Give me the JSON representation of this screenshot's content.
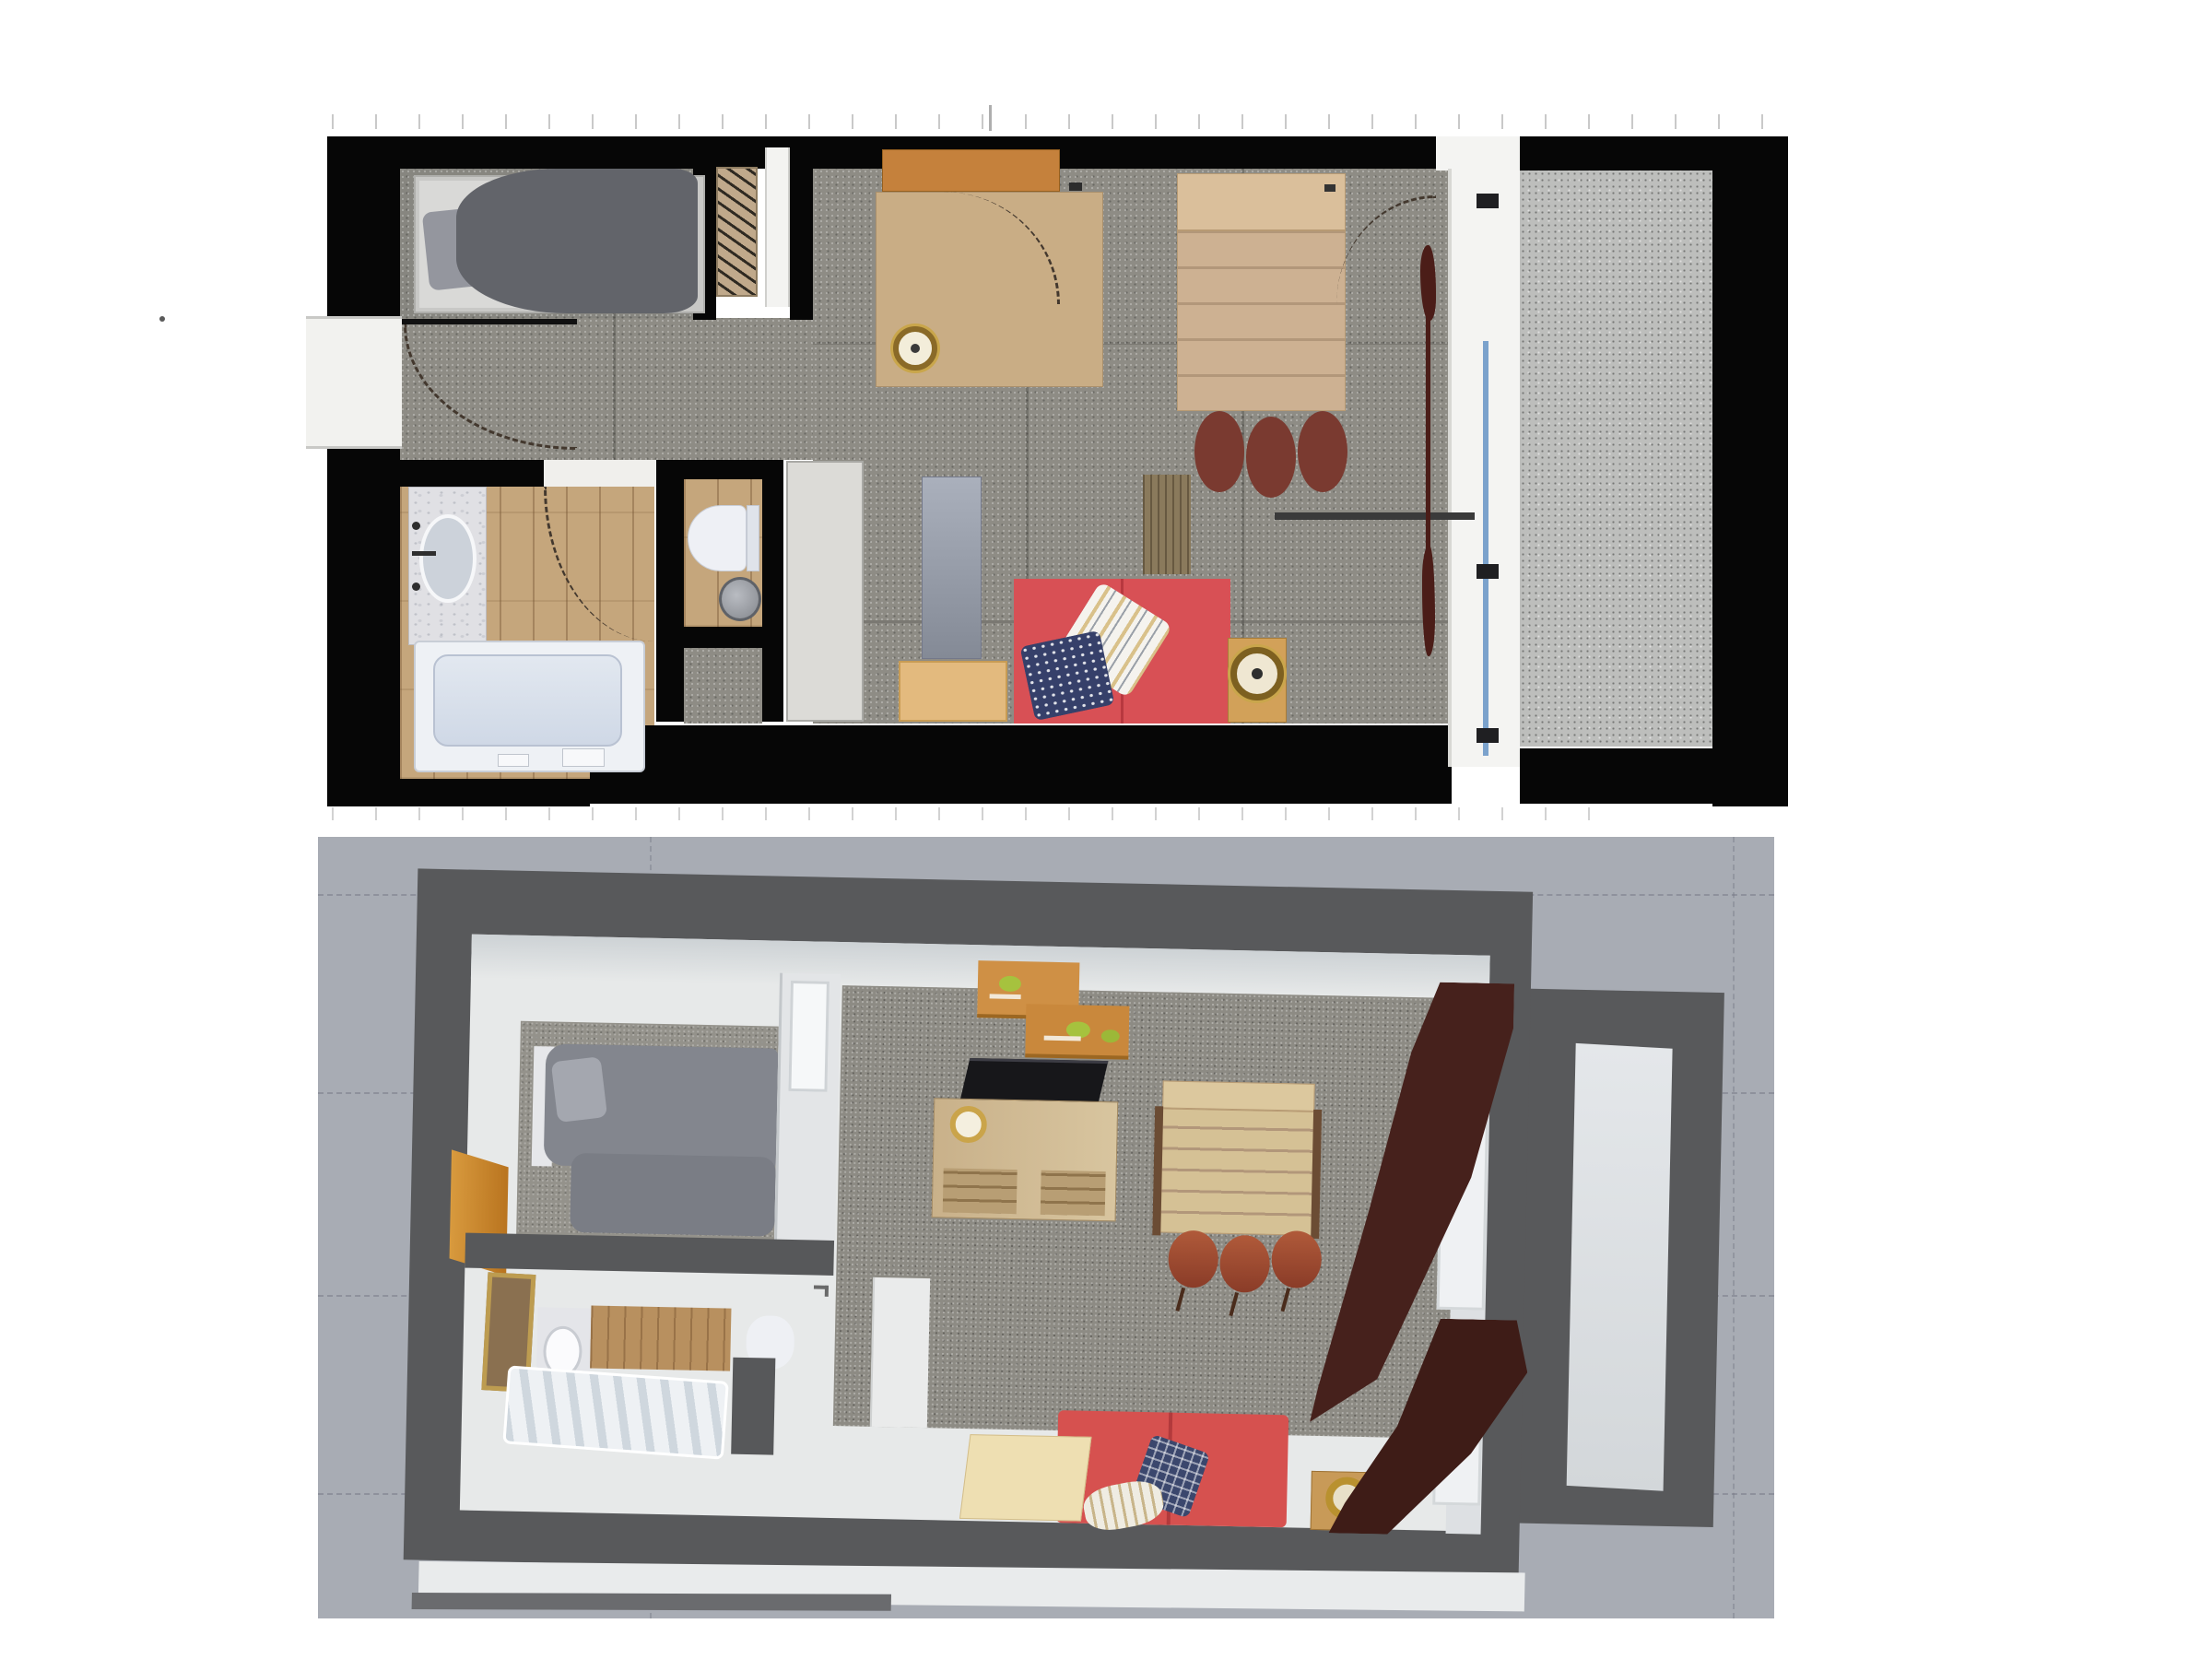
{
  "scene": {
    "type": "interior-design-studio-apartment-renders",
    "page_background": "#ffffff",
    "views_count": 2
  },
  "plan2d": {
    "kind": "top-down-floor-plan",
    "wall_color": "#060606",
    "carpet_color": "#8e8c85",
    "wood_floor_color": "#c5a67c",
    "balcony_floor_color": "#bdbebc",
    "glazing_frame_color": "#f4f4f2",
    "glazing_glass_line_color": "#7ba2cc",
    "door_swing_arcs": 4,
    "rooms": [
      {
        "name": "sleeping-alcove",
        "furniture": [
          "single-bed-gray",
          "radiator-slatted"
        ]
      },
      {
        "name": "hallway",
        "furniture": [
          "left-wall-window"
        ]
      },
      {
        "name": "bathroom",
        "furniture": [
          "vanity-sink-marble",
          "bathtub",
          "toilet",
          "round-waste-bin"
        ]
      },
      {
        "name": "living-room",
        "furniture": [
          "white-wardrobe",
          "gray-mirror-panel",
          "wall-shelf-orange",
          "desk-wood",
          "gold-clock",
          "dining-table-wood",
          "stool-red-brown",
          "stool-red-brown",
          "stool-red-brown",
          "red-sofa",
          "striped-cushion",
          "navy-cushion",
          "coffee-table-tan",
          "side-table-with-clock",
          "brown-rug",
          "maroon-curtain",
          "railing-line"
        ]
      },
      {
        "name": "balcony",
        "furniture": []
      }
    ],
    "stool_count": 3,
    "sofa_color": "#d85055",
    "bed_duvet_color": "#62646a"
  },
  "plan3d": {
    "kind": "tilted-perspective-overview",
    "background_color": "#a8acb4",
    "grid_style": "dashed",
    "wall_color": "#58595b",
    "interior_wall_color": "#e7e9e9",
    "balcony_slab_color": "#dce0e2",
    "rooms": [
      {
        "name": "sleeping-alcove",
        "furniture": [
          "bed-gray-duvets",
          "wood-door-orange",
          "partition-window"
        ]
      },
      {
        "name": "bathroom",
        "furniture": [
          "framed-mirror",
          "marble-sink",
          "wood-cabinet",
          "toilet",
          "ribbed-bathtub"
        ]
      },
      {
        "name": "living-room",
        "furniture": [
          "wall-shelves-with-plants",
          "tv-black",
          "desk-with-drawers",
          "gold-clock",
          "slatted-dining-table",
          "stool-red-brown",
          "stool-red-brown",
          "stool-red-brown",
          "red-sofa",
          "navy-check-cushion",
          "cream-cushion",
          "cream-coffee-table",
          "side-table-gold-ring",
          "white-wardrobe"
        ]
      },
      {
        "name": "balcony",
        "furniture": [
          "light-floor-slab"
        ]
      }
    ],
    "curtain_count": 2,
    "curtain_color": "#45201b",
    "stool_count": 3,
    "plant_color": "#a6c23e",
    "sofa_color": "#d6514f"
  },
  "palette": {
    "black_wall": "#060606",
    "carpet_gray": "#8e8c85",
    "wood_light": "#c5a67c",
    "desk_wood": "#c9ad85",
    "shelf_orange": "#c5813c",
    "table_tan": "#cdb192",
    "stool_maroon": "#7a3a30",
    "sofa_red": "#d85055",
    "navy_pillow": "#36406a",
    "gold": "#8a6a28",
    "curtain_maroon": "#4b1d18",
    "bg_3d": "#a8acb4",
    "wall_3d": "#58595b",
    "slab_3d": "#dce0e2",
    "door_orange": "#c8872f",
    "plant_green": "#a6c23e"
  }
}
